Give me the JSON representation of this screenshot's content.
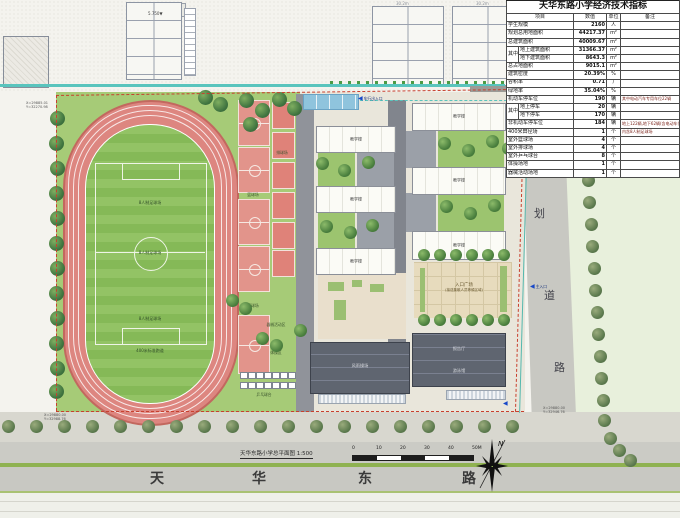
{
  "table": {
    "title": "天华东路小学经济技术指标",
    "headers": [
      "项目",
      "数值",
      "单位",
      "备注"
    ],
    "rows": [
      {
        "label": "学生规模",
        "value": "2160",
        "unit": "人",
        "note": ""
      },
      {
        "label": "规划总用地面积",
        "value": "44217.37",
        "unit": "m²",
        "note": ""
      },
      {
        "label": "总建筑面积",
        "value": "40009.67",
        "unit": "m²",
        "note": ""
      },
      {
        "label": "地上建筑面积",
        "value": "31366.37",
        "unit": "m²",
        "note": "",
        "group": "其中",
        "group_first": true,
        "group_span": 2
      },
      {
        "label": "地下建筑面积",
        "value": "8643.3",
        "unit": "m²",
        "note": "",
        "group": "其中"
      },
      {
        "label": "总占地面积",
        "value": "9015.1",
        "unit": "m²",
        "note": ""
      },
      {
        "label": "建筑密度",
        "value": "20.39%",
        "unit": "%",
        "note": ""
      },
      {
        "label": "容积率",
        "value": "0.71",
        "unit": "/",
        "note": ""
      },
      {
        "label": "绿地率",
        "value": "35.04%",
        "unit": "%",
        "note": ""
      },
      {
        "label": "机动车停车位",
        "value": "190",
        "unit": "辆",
        "note": "其中电动汽车专用车位22辆"
      },
      {
        "label": "地上停车",
        "value": "20",
        "unit": "辆",
        "note": "",
        "group": "其中",
        "group_first": true,
        "group_span": 2
      },
      {
        "label": "地下停车",
        "value": "170",
        "unit": "辆",
        "note": "",
        "group": "其中"
      },
      {
        "label": "非机动车停车位",
        "value": "184",
        "unit": "辆",
        "note": "地上122辆,地下62辆(含电动车位)"
      },
      {
        "label": "400米田径场",
        "value": "1",
        "unit": "个",
        "note": "内含8人制足球场"
      },
      {
        "label": "室外篮球场",
        "value": "4",
        "unit": "个",
        "note": ""
      },
      {
        "label": "室外排球场",
        "value": "4",
        "unit": "个",
        "note": ""
      },
      {
        "label": "室外乒乓球台",
        "value": "8",
        "unit": "个",
        "note": ""
      },
      {
        "label": "体操场地",
        "value": "1",
        "unit": "个",
        "note": ""
      },
      {
        "label": "器械活动场地",
        "value": "1",
        "unit": "个",
        "note": ""
      }
    ]
  },
  "plan": {
    "caption": "天华东路小学总平面图",
    "caption_scale": "1:500",
    "scalebar_ticks": [
      "0",
      "10",
      "20",
      "30",
      "40",
      "50M"
    ],
    "north_letter": "N",
    "south_road_chars": [
      "天",
      "华",
      "东",
      "路"
    ],
    "east_road_chars": [
      "划",
      "道",
      "路"
    ],
    "labels": {
      "soccer": "8人制足球场",
      "track": "400米标准跑道",
      "basketball": "篮球场",
      "volleyball": "排球场",
      "pingpong": "乒乓球台",
      "gymnastics": "体操区",
      "apparatus": "器械活动区",
      "plaza_line1": "入口广场",
      "plaza_line2": "(接送集散人员等候区域)",
      "teach": "教学楼",
      "gym": "风雨操场",
      "hall": "报告厅",
      "pool_hall": "游泳馆",
      "entry_north": "车行出入口",
      "entry_east": "主入口"
    },
    "context": {
      "elev_mark": "5.750",
      "dim_a": "30.2m",
      "dim_b": "30.2m"
    },
    "coords": {
      "tl": [
        "X=29885.01",
        "Y=32270.98"
      ],
      "bl": [
        "X=29880.00",
        "Y=32988.76"
      ],
      "br": [
        "X=29880.00",
        "Y=32946.76"
      ]
    }
  },
  "colors": {
    "track": "#DD8680",
    "court": "#E2948B",
    "lawn": "#A6CB77",
    "field": "#8FC162",
    "road": "#C8C8C2",
    "paving": "#E9E6DB",
    "red_line": "#C8402E",
    "water": "#8FC4DD",
    "dark_roof": "#5F6570",
    "plaza": "#E7DBBD",
    "canal": "#59C4BD",
    "note_red": "#7C241B"
  }
}
